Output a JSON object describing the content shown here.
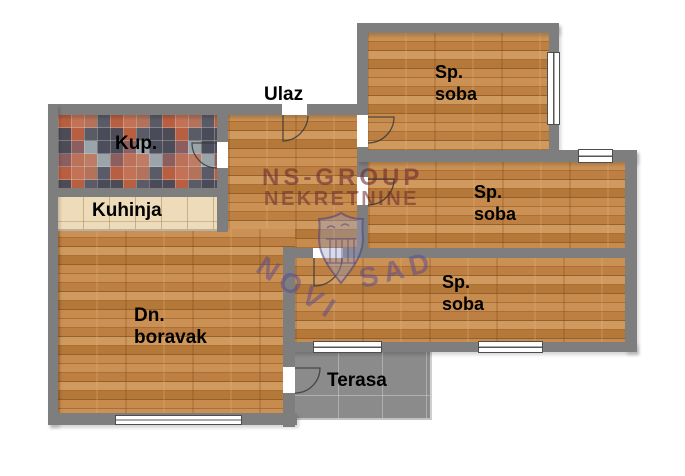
{
  "plan": {
    "rooms": {
      "entrance": {
        "label": "Ulaz"
      },
      "bathroom": {
        "label": "Kup."
      },
      "kitchen": {
        "label": "Kuhinja"
      },
      "living": {
        "line1": "Dn.",
        "line2": "boravak"
      },
      "bedroom1": {
        "line1": "Sp.",
        "line2": "soba"
      },
      "bedroom2": {
        "line1": "Sp.",
        "line2": "soba"
      },
      "bedroom3": {
        "line1": "Sp.",
        "line2": "soba"
      },
      "terrace": {
        "label": "Terasa"
      }
    }
  },
  "watermark": {
    "line1": "NS-GROUP",
    "line2": "NEKRETNINE",
    "word1": "NOVI",
    "word2": "SAD"
  },
  "colors": {
    "wall": "#7e7e7e",
    "wood_floor": "#c08348",
    "terrace_floor": "#8b8b8b",
    "kitchen_tile": "#eddbb9",
    "label_text": "#000000",
    "watermark_maroon": "#68282e",
    "watermark_purple": "#544894"
  }
}
